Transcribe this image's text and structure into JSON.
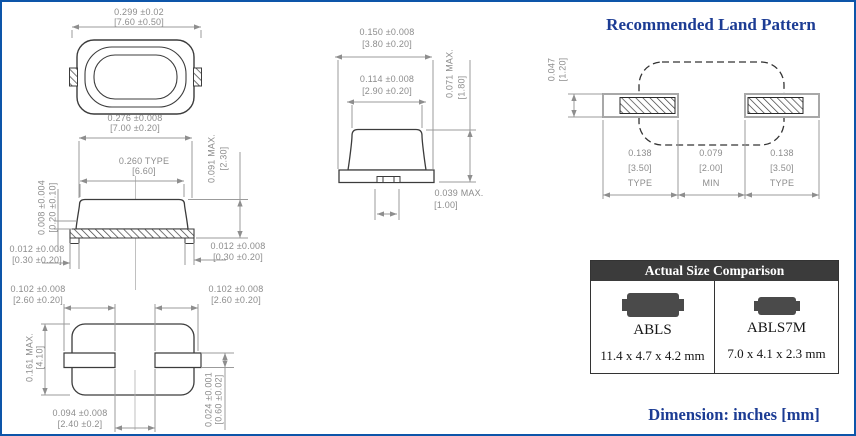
{
  "land_pattern": {
    "title": "Recommended Land Pattern",
    "dim_pad_height": {
      "in": "0.047",
      "mm": "[1.20]"
    },
    "dim_left": {
      "in": "0.138",
      "mm": "[3.50]",
      "note": "TYPE"
    },
    "dim_center": {
      "in": "0.079",
      "mm": "[2.00]",
      "note": "MIN"
    },
    "dim_right": {
      "in": "0.138",
      "mm": "[3.50]",
      "note": "TYPE"
    }
  },
  "top_view": {
    "dim_overall_width": {
      "in": "0.299 ±0.02",
      "mm": "[7.60 ±0.50]"
    },
    "dim_body_width": {
      "in": "0.276 ±0.008",
      "mm": "[7.00 ±0.20]"
    }
  },
  "side_view": {
    "dim_lid_width": {
      "in": "0.260 TYPE",
      "mm": "[6.60]"
    },
    "dim_height": {
      "in": "0.091 MAX.",
      "mm": "[2.30]"
    },
    "dim_lid_thickness": {
      "in": "0.008 ±0.004",
      "mm": "[0.20 ±0.10]"
    },
    "dim_pad_left": {
      "in": "0.012 ±0.008",
      "mm": "[0.30 ±0.20]"
    },
    "dim_pad_right": {
      "in": "0.012 ±0.008",
      "mm": "[0.30 ±0.20]"
    }
  },
  "bottom_view": {
    "dim_pad_width_left": {
      "in": "0.102 ±0.008",
      "mm": "[2.60 ±0.20]"
    },
    "dim_pad_width_right": {
      "in": "0.102 ±0.008",
      "mm": "[2.60 ±0.20]"
    },
    "dim_body_height": {
      "in": "0.161 MAX.",
      "mm": "[4.10]"
    },
    "dim_pad_gap": {
      "in": "0.094 ±0.008",
      "mm": "[2.40 ±0.2]"
    },
    "dim_pad_height": {
      "in": "0.024 ±0.001",
      "mm": "[0.60 ±0.02]"
    }
  },
  "end_view": {
    "dim_overall_width": {
      "in": "0.150 ±0.008",
      "mm": "[3.80 ±0.20]"
    },
    "dim_lid_width": {
      "in": "0.114 ±0.008",
      "mm": "[2.90 ±0.20]"
    },
    "dim_height": {
      "in": "0.071 MAX.",
      "mm": "[1.80]"
    },
    "dim_tab": {
      "in": "0.039 MAX.",
      "mm": "[1.00]"
    }
  },
  "size_comparison": {
    "header": "Actual Size Comparison",
    "items": [
      {
        "name": "ABLS",
        "size": "11.4 x 4.7 x 4.2 mm"
      },
      {
        "name": "ABLS7M",
        "size": "7.0 x 4.1 x 2.3 mm"
      }
    ]
  },
  "meta": {
    "footer": "Dimension: inches [mm]"
  },
  "colors": {
    "frame_blue": "#0d55a9",
    "title_navy": "#1c3c94",
    "dim_text_gray": "#8c8c8c",
    "drawing_line": "#3c3c3c",
    "table_header_bg": "#3b3b3b",
    "chip_gray": "#4a4a4a"
  }
}
